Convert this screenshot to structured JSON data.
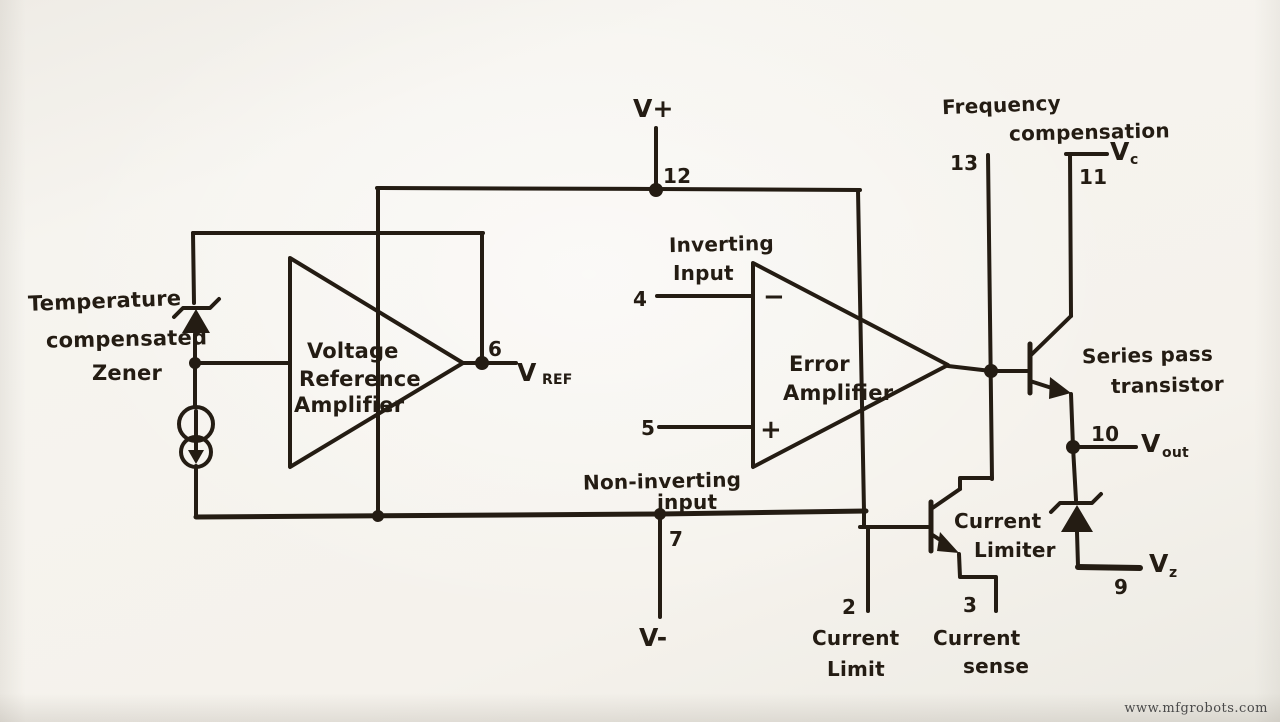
{
  "colors": {
    "ink": "#241c13",
    "paper": "#f4f1eb",
    "watermark_color": "#4a4a4a"
  },
  "watermark": "www.mfgrobots.com",
  "labels": {
    "temperature_zener": [
      "Temperature",
      "compensated",
      "Zener"
    ],
    "voltage_reference_amplifier": [
      "Voltage",
      "Reference",
      "Amplifier"
    ],
    "error_amplifier": [
      "Error",
      "Amplifier"
    ],
    "inverting_input": [
      "Inverting",
      "Input"
    ],
    "non_inverting_input": [
      "Non-inverting",
      "input"
    ],
    "frequency_compensation": [
      "Frequency",
      "compensation"
    ],
    "series_pass_transistor": [
      "Series pass",
      "transistor"
    ],
    "current_limiter": [
      "Current",
      "Limiter"
    ],
    "minus_sign": "−",
    "plus_sign": "+"
  },
  "pins": {
    "v_plus": {
      "number": "12",
      "name": "V+"
    },
    "vref": {
      "number": "6",
      "base": "V",
      "sub": "REF"
    },
    "inverting_input": {
      "number": "4"
    },
    "non_inverting_input": {
      "number": "5"
    },
    "v_minus": {
      "number": "7",
      "name": "V-"
    },
    "frequency_compensation": {
      "number": "13"
    },
    "vc": {
      "number": "11",
      "base": "V",
      "sub": "c"
    },
    "v_out": {
      "number": "10",
      "base": "V",
      "sub": "out"
    },
    "v_z": {
      "number": "9",
      "base": "V",
      "sub": "z"
    },
    "current_limit": {
      "number": "2",
      "label_lines": [
        "Current",
        "Limit"
      ]
    },
    "current_sense": {
      "number": "3",
      "label_lines": [
        "Current",
        "sense"
      ]
    }
  }
}
